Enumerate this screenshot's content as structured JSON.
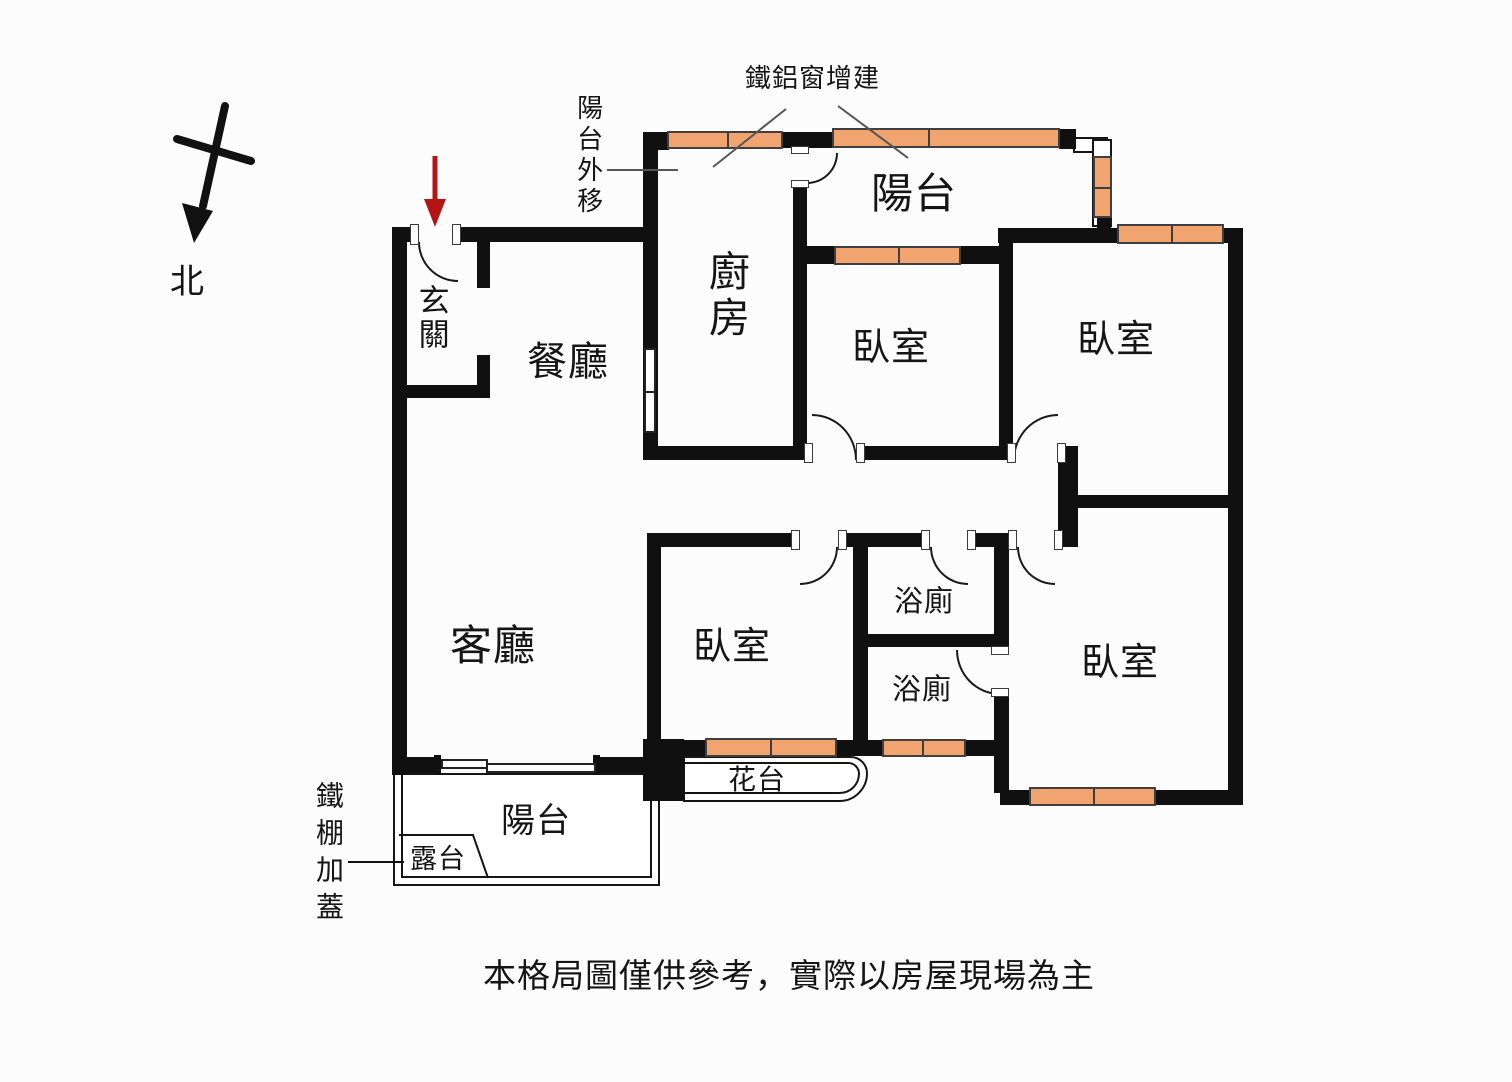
{
  "compass": {
    "north_label": "北"
  },
  "annotations": {
    "window_addition": "鐵鋁窗增建",
    "balcony_extended": "陽台外移",
    "iron_shed_cover": "鐵棚加蓋"
  },
  "rooms": {
    "foyer": "玄關",
    "dining": "餐廳",
    "kitchen": "廚房",
    "balcony_top": "陽台",
    "bedroom_a": "臥室",
    "bedroom_b": "臥室",
    "living": "客廳",
    "bedroom_c": "臥室",
    "bath_a": "浴廁",
    "bath_b": "浴廁",
    "bedroom_d": "臥室",
    "flower_bed": "花台",
    "balcony_bottom": "陽台",
    "terrace": "露台"
  },
  "footer": {
    "note": "本格局圖僅供參考，實際以房屋現場為主"
  },
  "colors": {
    "wall": "#101010",
    "window_fill": "#F2A470",
    "window_border": "#3f3f3f",
    "entry_arrow_red": "#b51414",
    "leader_line": "#555555"
  }
}
